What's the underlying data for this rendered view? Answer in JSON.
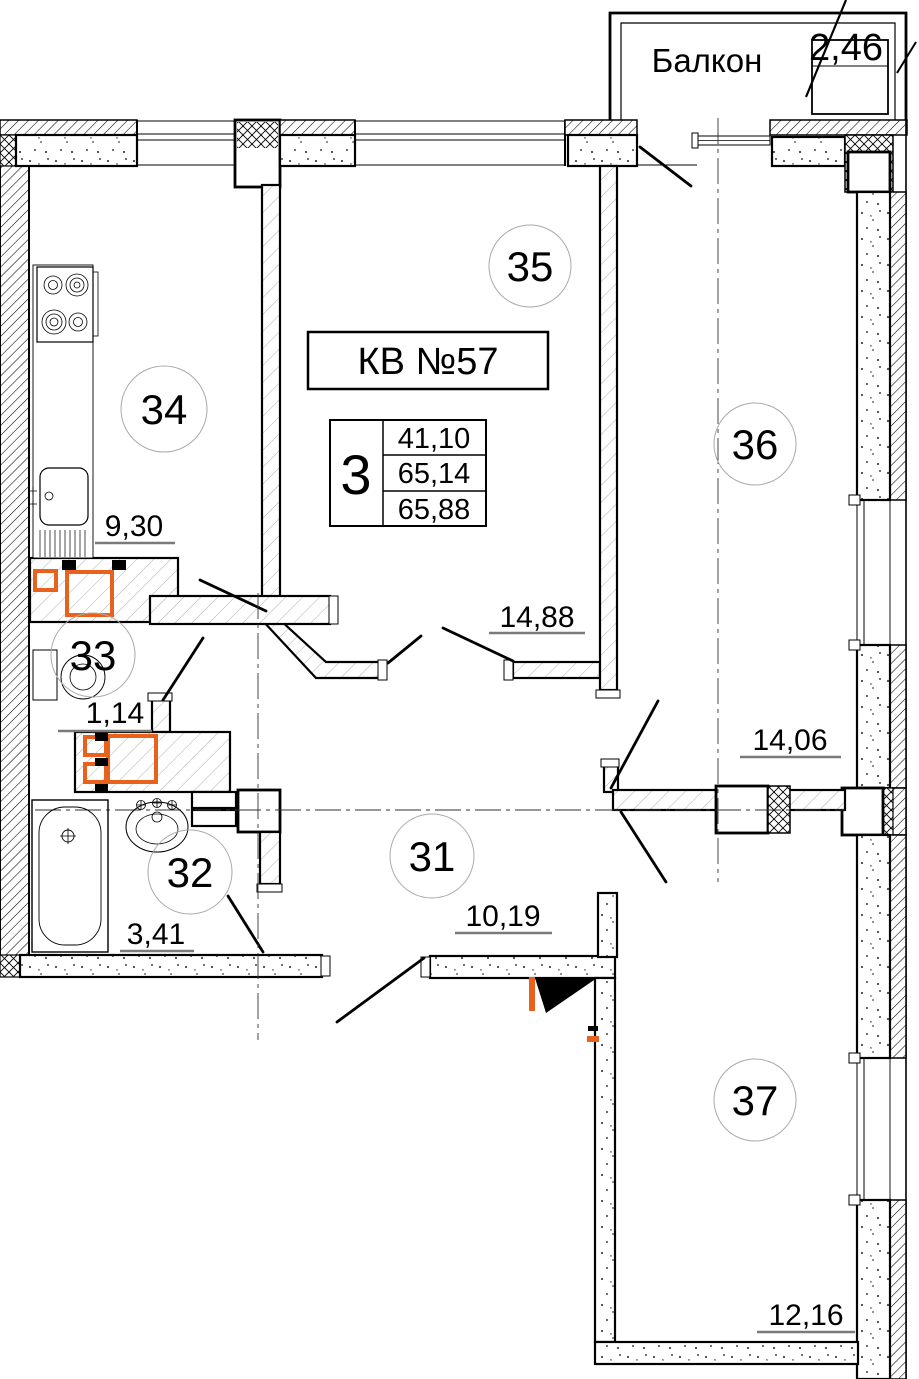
{
  "plan": {
    "apartment": {
      "label": "КВ №57"
    },
    "balcony": {
      "label": "Балкон",
      "area": "2,46"
    },
    "summary": {
      "rooms_count": "3",
      "living_area": "41,10",
      "area_without_balcony": "65,14",
      "total_area": "65,88"
    },
    "rooms": {
      "r31": {
        "number": "31",
        "area": "10,19"
      },
      "r32": {
        "number": "32",
        "area": "3,41"
      },
      "r33": {
        "number": "33",
        "area": "1,14"
      },
      "r34": {
        "number": "34",
        "area": "9,30"
      },
      "r35": {
        "number": "35",
        "area": "14,88"
      },
      "r36": {
        "number": "36",
        "area": "14,06"
      },
      "r37": {
        "number": "37",
        "area": "12,16"
      }
    },
    "colors": {
      "accent_orange": "#E8621D",
      "wall": "#000000",
      "dim_underline": "#7a7a7a"
    }
  }
}
